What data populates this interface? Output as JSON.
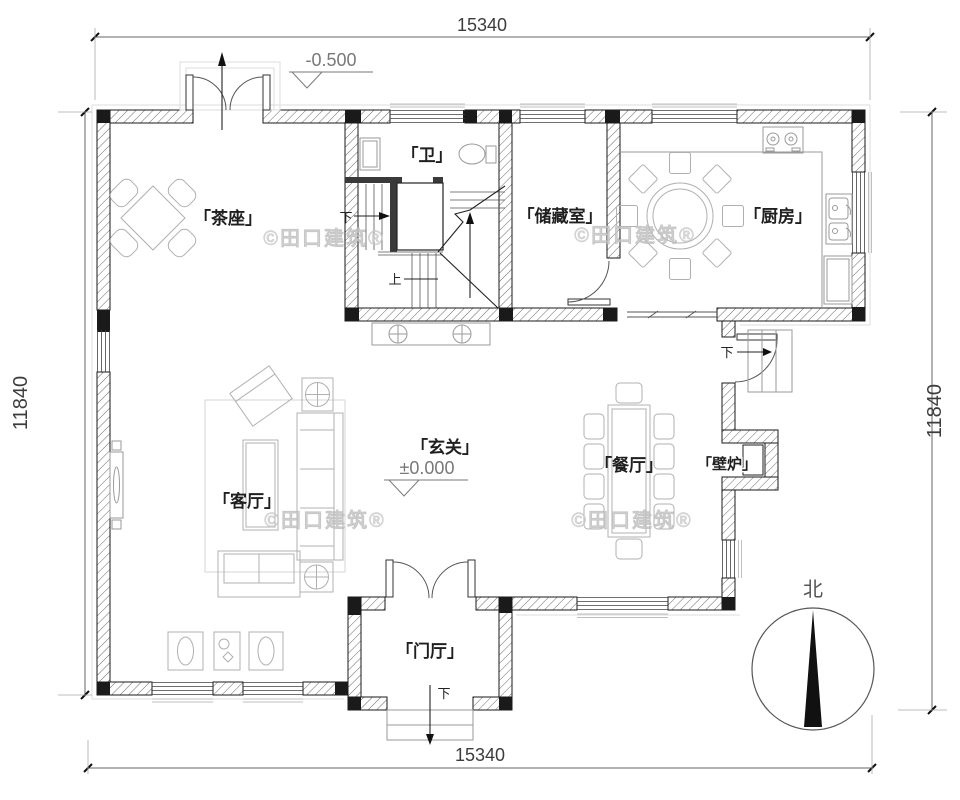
{
  "plan": {
    "type": "residential-floor-plan",
    "dim_top": "15340",
    "dim_bottom": "15340",
    "dim_left": "11840",
    "dim_right": "11840",
    "elev_entry": "-0.500",
    "elev_main": "±0.000",
    "rooms": {
      "tea": "「茶座」",
      "bath": "「卫」",
      "storage": "「储藏室」",
      "kitchen": "「厨房」",
      "hall": "「玄关」",
      "living": "「客厅」",
      "dining": "「餐厅」",
      "fireplace": "「壁炉」",
      "foyer": "「门厅」"
    },
    "stair_down": "下",
    "stair_up": "上",
    "side_down": "下",
    "entry_down": "下",
    "north": "北",
    "watermark": "©田口建筑®",
    "colors": {
      "wall_line": "#1a1a1a",
      "furniture": "#b0b0b0",
      "watermark": "#d2d2d2",
      "dimension_text": "#3c3c3c",
      "elevation_text": "#787878"
    }
  }
}
